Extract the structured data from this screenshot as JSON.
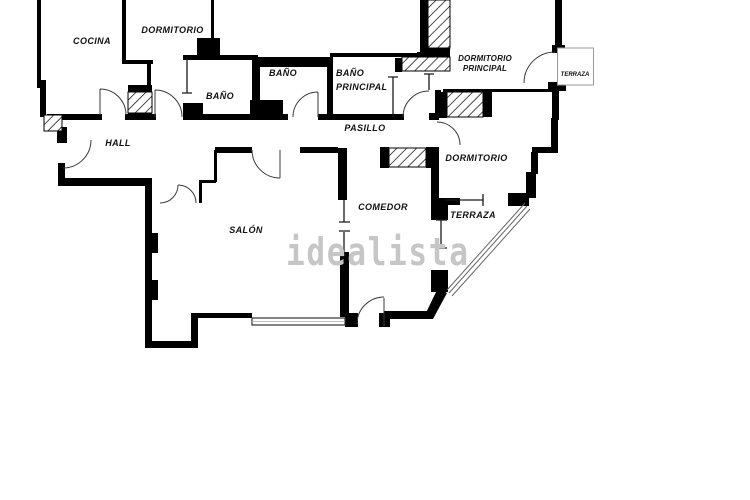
{
  "watermark": {
    "text": "idealista",
    "color": "#c6c6c6"
  },
  "colors": {
    "wall": "#000000",
    "door_arc": "#3a3a3a",
    "thin_partition": "#1a1a1a",
    "window_outline": "#333333",
    "terraza_box_border": "#999999",
    "glazing_line": "#666666",
    "background": "#ffffff"
  },
  "rooms": {
    "cocina": {
      "label": "COCINA"
    },
    "dormitorio_superior": {
      "label": "DORMITORIO"
    },
    "bano_izquierdo": {
      "label": "BAÑO"
    },
    "bano_central": {
      "label": "BAÑO"
    },
    "bano_principal": {
      "label_line1": "BAÑO",
      "label_line2": "PRINCIPAL"
    },
    "dormitorio_principal": {
      "label_line1": "DORMITORIO",
      "label_line2": "PRINCIPAL"
    },
    "terraza_superior": {
      "label": "TERRAZA"
    },
    "hall": {
      "label": "HALL"
    },
    "pasillo": {
      "label": "PASILLO"
    },
    "dormitorio_derecho": {
      "label": "DORMITORIO"
    },
    "comedor": {
      "label": "COMEDOR"
    },
    "salon": {
      "label": "SALÓN"
    },
    "terraza_inferior": {
      "label": "TERRAZA"
    }
  }
}
